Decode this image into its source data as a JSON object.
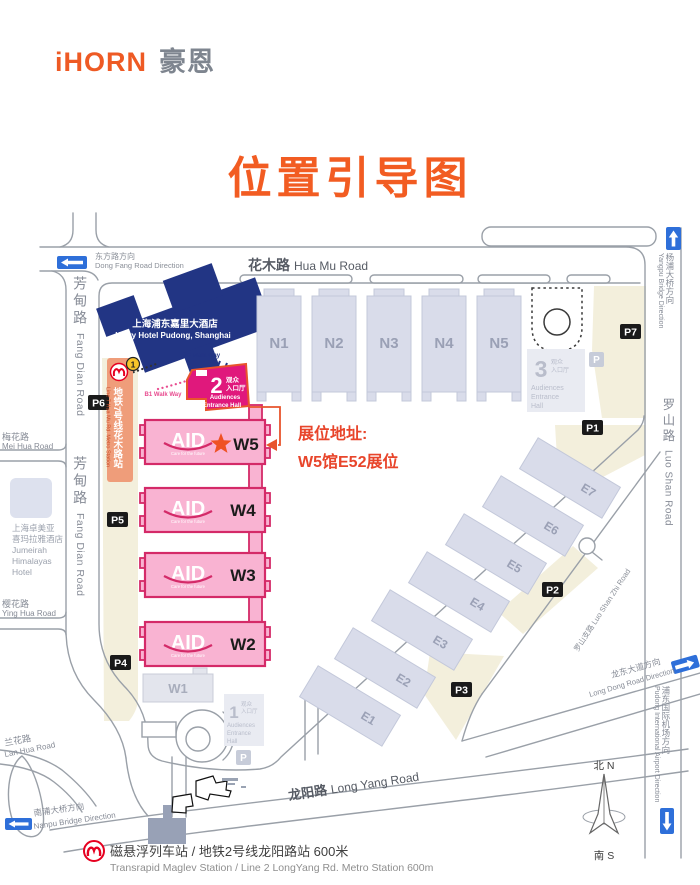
{
  "header": {
    "logo_en": "iHORN",
    "logo_cn": "豪恩",
    "title": "位置引导图"
  },
  "booth": {
    "line1": "展位地址:",
    "line2": "W5馆E52展位"
  },
  "roads": {
    "hua_mu_cn": "花木路",
    "hua_mu_en": "Hua Mu Road",
    "fang_dian_cn": "芳甸路",
    "fang_dian_en": "Fang Dian Road",
    "luo_shan_cn": "罗山路",
    "luo_shan_en": "Luo Shan Road",
    "luo_shan_zhi": "罗山支路 Luo Shan Zhi Road",
    "long_yang_cn": "龙阳路",
    "long_yang_en": "Long Yang Road",
    "mei_hua_cn": "梅花路",
    "mei_hua_en": "Mei Hua Road",
    "ying_hua_cn": "樱花路",
    "ying_hua_en": "Ying Hua Road",
    "lan_hua_cn": "兰花路",
    "lan_hua_en": "Lan Hua Road"
  },
  "directions": {
    "dong_fang_cn": "东方路方向",
    "dong_fang_en": "Dong Fang Road Direction",
    "yangpu_cn": "杨浦大桥方向",
    "yangpu_en": "Yangpu Bridge Direction",
    "nanpu_cn": "南浦大桥方向",
    "nanpu_en": "Nanpu Bridge Direction",
    "long_dong_cn": "龙东大道方向",
    "long_dong_en": "Long Dong Road Direction",
    "airport_cn": "浦东国际机场方向",
    "airport_en": "Pudong International Airport Direction"
  },
  "landmarks": {
    "kerry_cn": "上海浦东嘉里大酒店",
    "kerry_en": "Kerry Hotel Pudong, Shanghai",
    "walkway_2f": "2F Walk Way",
    "walkway_b1": "B1 Walk Way",
    "jumeirah_lines": [
      "上海卓美亚",
      "喜玛拉雅酒店",
      "Jumeirah",
      "Himalayas",
      "Hotel"
    ],
    "metro7_cn": "地铁7号线花木路站",
    "metro7_en": "Line 7 Hua Mu Rd. Metro Station",
    "exit_no": "1"
  },
  "halls": {
    "north": [
      "N1",
      "N2",
      "N3",
      "N4",
      "N5"
    ],
    "west": [
      "W5",
      "W4",
      "W3",
      "W2"
    ],
    "w1": "W1",
    "east": [
      "E1",
      "E2",
      "E3",
      "E4",
      "E5",
      "E6",
      "E7"
    ],
    "aid_logo": "AID",
    "aid_tagline": "Care for the future"
  },
  "entrances": {
    "e1": {
      "num": "1",
      "cn1": "观众",
      "cn2": "入口厅",
      "en1": "Audiences",
      "en2": "Entrance",
      "en3": "Hall"
    },
    "e2": {
      "num": "2",
      "cn1": "观众",
      "cn2": "入口厅",
      "en1": "Audiences",
      "en2": "Entrance Hall"
    },
    "e3": {
      "num": "3",
      "cn1": "观众",
      "cn2": "入口厅",
      "en1": "Audiences",
      "en2": "Entrance",
      "en3": "Hall"
    },
    "gray_p": "P"
  },
  "parking": [
    "P1",
    "P2",
    "P3",
    "P4",
    "P5",
    "P6",
    "P7"
  ],
  "compass": {
    "north": "北 N",
    "south": "南 S"
  },
  "footer": {
    "cn": "磁悬浮列车站 / 地铁2号线龙阳路站 600米",
    "en": "Transrapid Maglev Station / Line 2 LongYang Rd. Metro Station  600m"
  },
  "colors": {
    "brand_orange": "#ee5a24",
    "title_orange": "#f25c22",
    "crimson": "#d42a68",
    "pink": "#f9b3d2",
    "magenta": "#e0187c",
    "navy": "#223584",
    "arrow_blue": "#2e6fd9",
    "beige": "#f3efdc",
    "hall_fill": "#d9dcea",
    "hall_text": "#9aa0b5",
    "road_gray": "#9aa0a8",
    "booth_red": "#e8452b",
    "metro_red": "#e60020",
    "line7_orange": "#ef9d7a",
    "exit_yellow": "#f6c52a"
  }
}
